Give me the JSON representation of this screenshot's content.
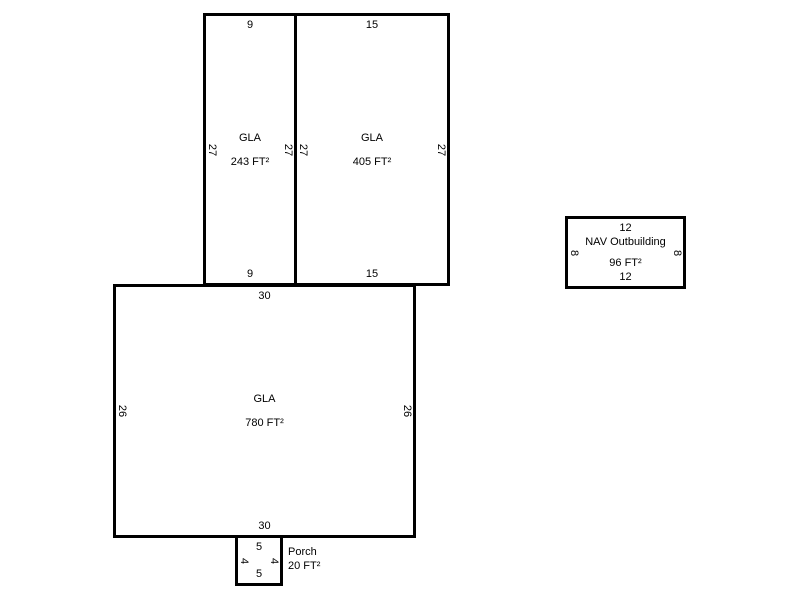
{
  "sketch": {
    "background_color": "#ffffff",
    "line_color": "#000000",
    "text_color": "#000000",
    "units": {
      "gla_243": {
        "name": "GLA",
        "area": "243 FT²",
        "top": "9",
        "bottom": "9",
        "left": "27",
        "right": "27"
      },
      "gla_405": {
        "name": "GLA",
        "area": "405 FT²",
        "top": "15",
        "bottom": "15",
        "left": "27",
        "right": "27"
      },
      "gla_780": {
        "name": "GLA",
        "area": "780 FT²",
        "top": "30",
        "bottom": "30",
        "left": "26",
        "right": "26"
      },
      "porch": {
        "name": "Porch",
        "area": "20 FT²",
        "top": "5",
        "bottom": "5",
        "left": "4",
        "right": "4"
      },
      "outbuilding": {
        "name": "NAV Outbuilding",
        "area": "96 FT²",
        "top": "12",
        "bottom": "12",
        "left": "8",
        "right": "8"
      }
    }
  }
}
